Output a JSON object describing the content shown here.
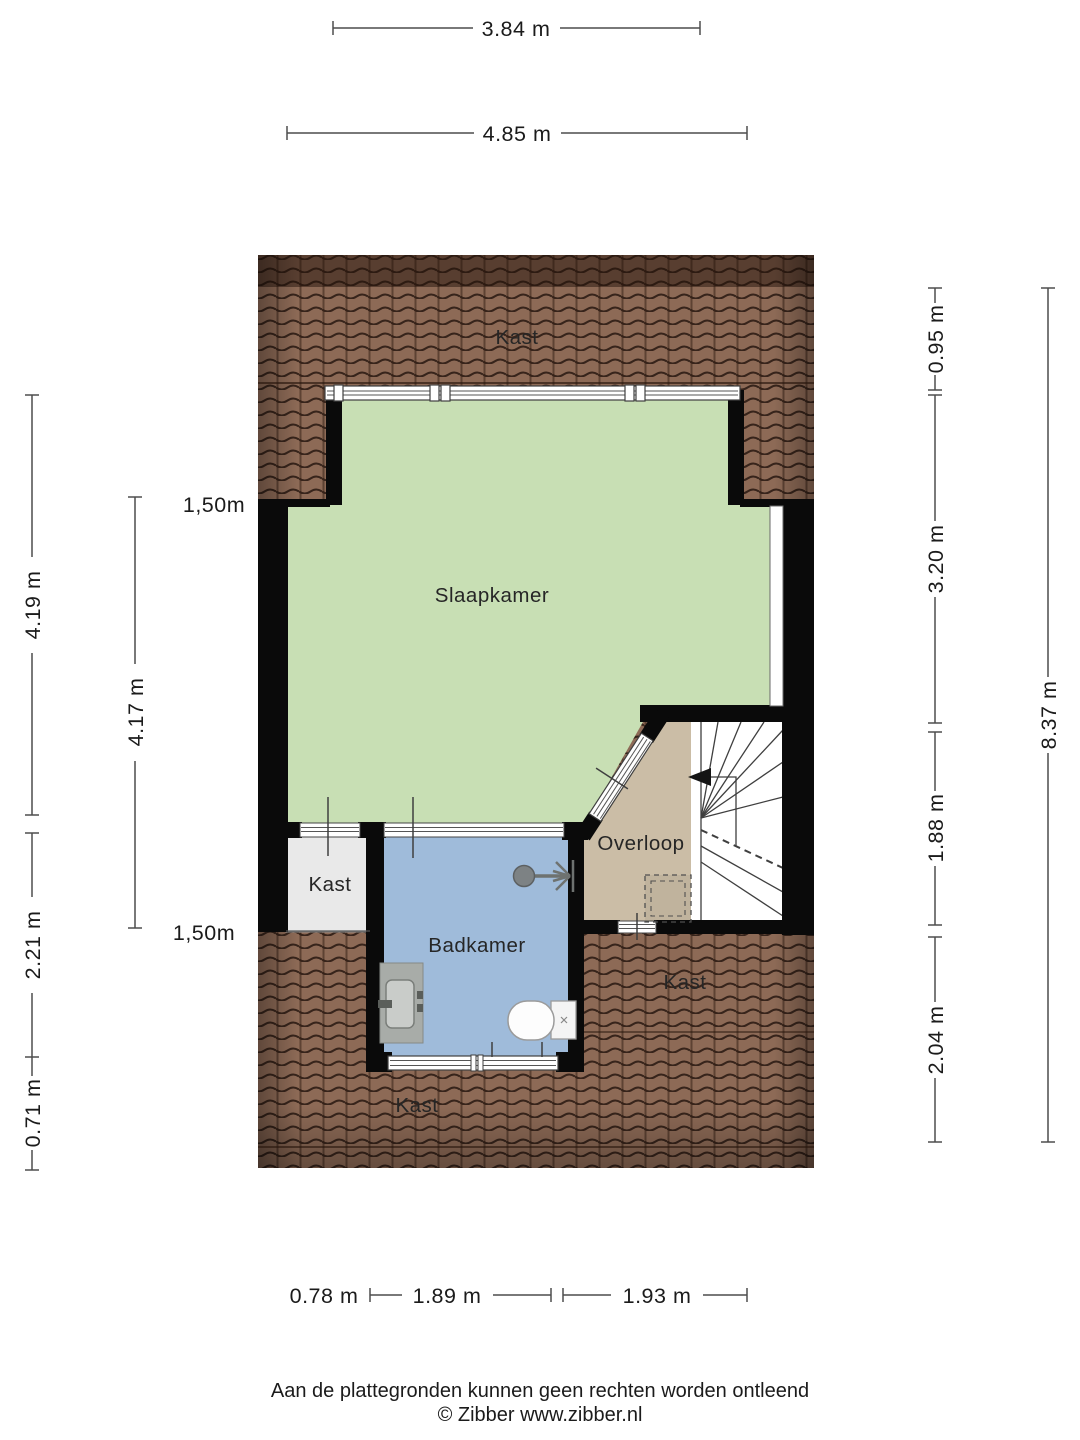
{
  "rooms": {
    "kast_top": "Kast",
    "slaapkamer": "Slaapkamer",
    "kast_left": "Kast",
    "badkamer": "Badkamer",
    "overloop": "Overloop",
    "kast_right": "Kast",
    "kast_bottom": "Kast"
  },
  "dimensions": {
    "top_inner": "3.84 m",
    "top_outer": "4.85 m",
    "left_a": "4.19 m",
    "left_b": "2.21 m",
    "left_c": "0.71 m",
    "left_inner": "4.17 m",
    "knee_top": "1,50m",
    "knee_bottom": "1,50m",
    "right_a": "0.95 m",
    "right_b": "3.20 m",
    "right_c": "1.88 m",
    "right_d": "2.04 m",
    "right_total": "8.37 m",
    "bottom_a": "0.78 m",
    "bottom_b": "1.89 m",
    "bottom_c": "1.93 m"
  },
  "footer": {
    "disclaimer": "Aan de plattegronden kunnen geen rechten worden ontleend",
    "credit": "© Zibber www.zibber.nl"
  },
  "colors": {
    "bedroom": "#c8dfb4",
    "bathroom": "#9fbbda",
    "landing": "#cbbda6",
    "closet": "#e9e9e9",
    "stairwell": "#ffffff",
    "roof": "#8d6a56",
    "wall": "#0a0a0a"
  }
}
